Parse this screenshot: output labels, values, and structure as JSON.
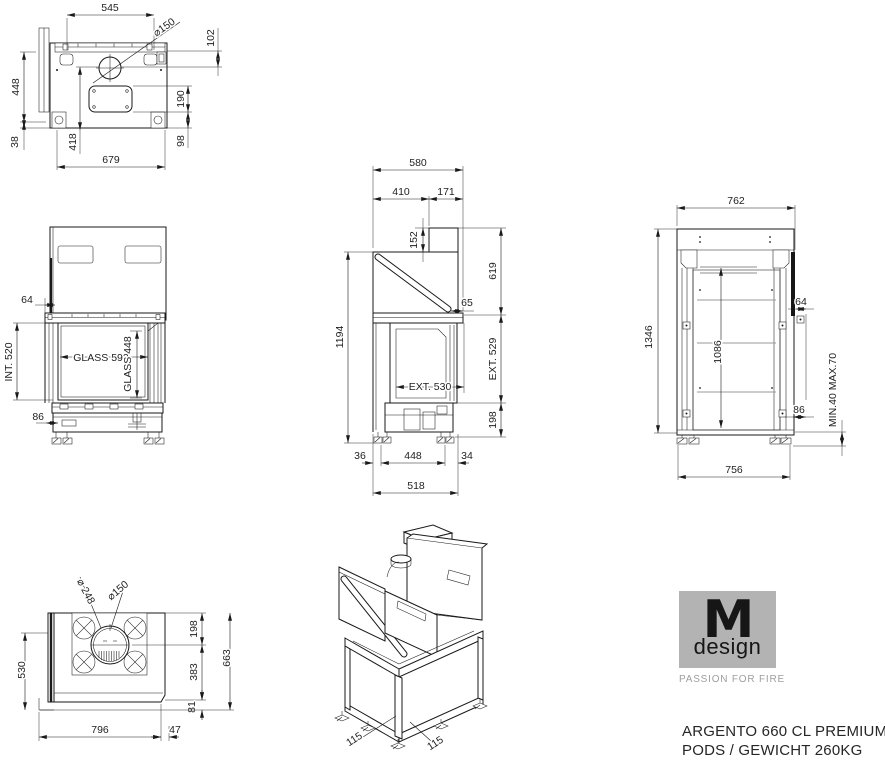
{
  "colors": {
    "line": "#1a1a1a",
    "gray_line": "#9a9a9a",
    "logo_bg": "#b3b3b3",
    "tagline_gray": "#9e9e9e"
  },
  "branding": {
    "logo_m": "M",
    "logo_design": "design",
    "tagline": "PASSION FOR FIRE"
  },
  "title": {
    "line1": "ARGENTO 660 CL PREMIUM",
    "line2": "PODS / GEWICHT 260KG"
  },
  "views": {
    "top": {
      "dims": {
        "w545": "545",
        "dia150": "⌀150",
        "h102": "102",
        "d448": "448",
        "d38": "38",
        "d418": "418",
        "d190": "190",
        "d98": "98",
        "w679": "679"
      }
    },
    "front": {
      "dims": {
        "o64": "64",
        "int520": "INT. 520",
        "glass592": "GLASS 592",
        "glass448": "GLASS 448",
        "b86": "86"
      }
    },
    "side": {
      "dims": {
        "d580": "580",
        "d410": "410",
        "d171": "171",
        "h152": "152",
        "h619": "619",
        "o65": "65",
        "h1194": "1194",
        "ext530": "EXT. 530",
        "ext529": "EXT. 529",
        "h198": "198",
        "f36": "36",
        "f448": "448",
        "f34": "34",
        "d518": "518"
      }
    },
    "back": {
      "dims": {
        "w762": "762",
        "h1346": "1346",
        "h1086": "1086",
        "o64": "64",
        "o86": "86",
        "feet_range": "MIN.40 MAX.70",
        "w756": "756"
      }
    },
    "bottom": {
      "dims": {
        "dia248": "⌀ 248",
        "dia150": "⌀150",
        "d198": "198",
        "d530": "530",
        "d383": "383",
        "d663": "663",
        "d81": "81",
        "w796": "796",
        "o47": "47"
      }
    },
    "iso": {
      "dims": {
        "f115a": "115",
        "f115b": "115"
      }
    }
  }
}
